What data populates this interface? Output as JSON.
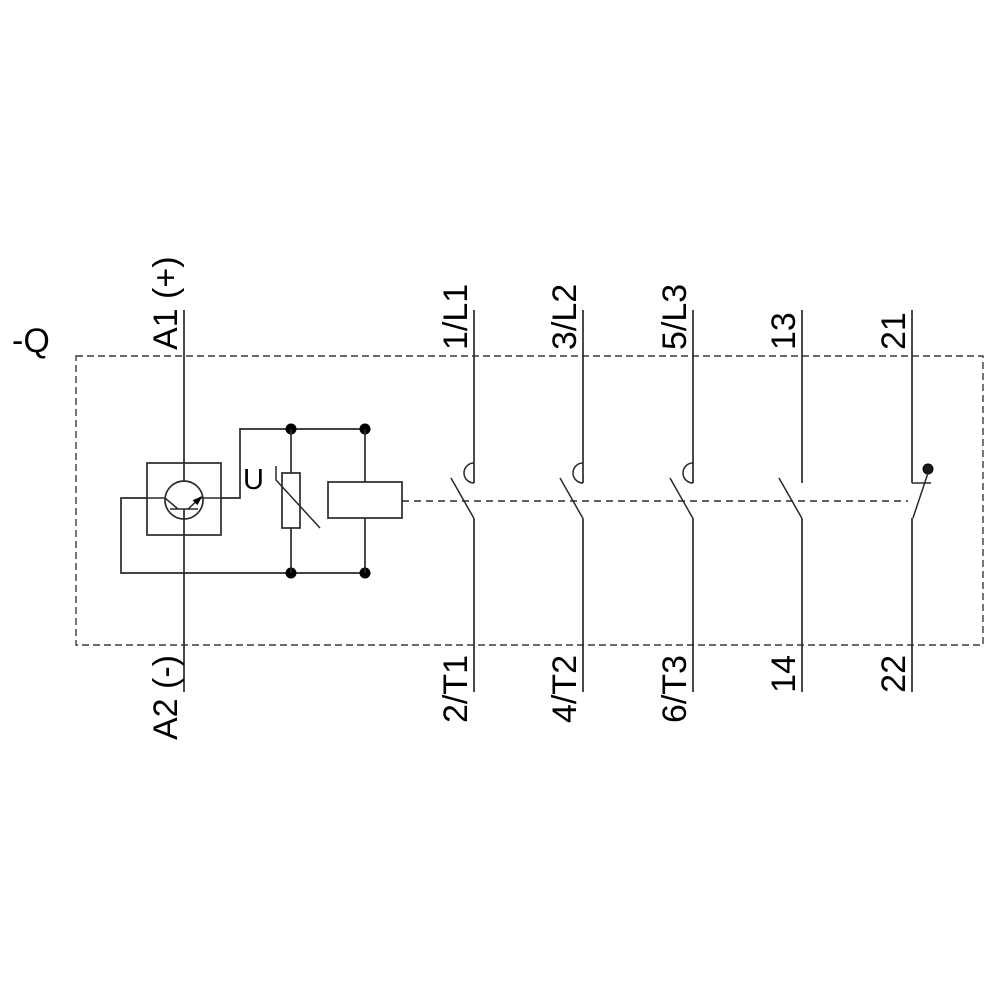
{
  "schematic": {
    "device_label": "-Q",
    "coil_circuit": {
      "terminal_top": "A1 (+)",
      "terminal_bottom": "A2 (-)",
      "varistor_label": "U"
    },
    "poles": [
      {
        "type": "main NO contact",
        "top": "1/L1",
        "bottom": "2/T1"
      },
      {
        "type": "main NO contact",
        "top": "3/L2",
        "bottom": "4/T2"
      },
      {
        "type": "main NO contact",
        "top": "5/L3",
        "bottom": "6/T3"
      },
      {
        "type": "auxiliary NO contact",
        "top": "13",
        "bottom": "14"
      },
      {
        "type": "auxiliary NC contact",
        "top": "21",
        "bottom": "22"
      }
    ],
    "colors": {
      "line": "#2a2a2a",
      "text": "#000000",
      "background": "#ffffff"
    }
  }
}
